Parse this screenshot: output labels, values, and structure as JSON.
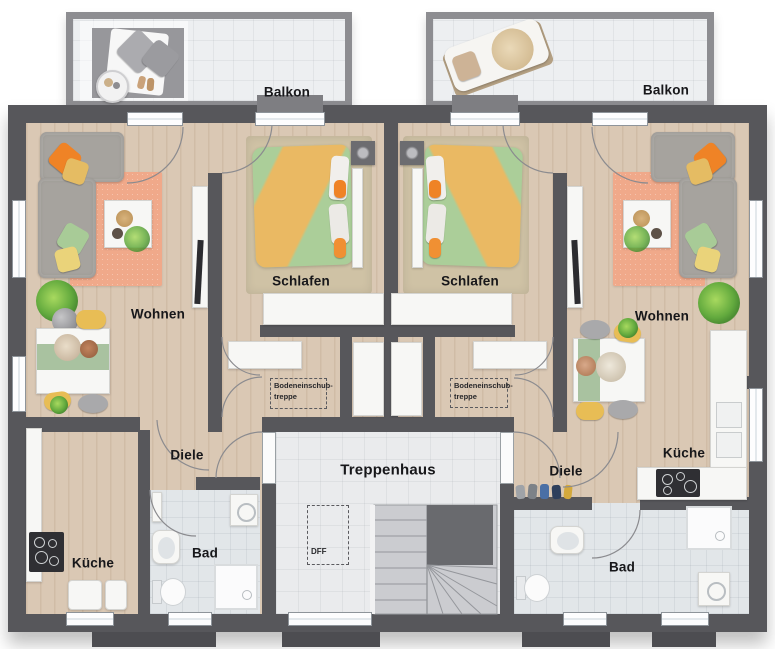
{
  "rooms": [
    {
      "id": "balkon-left",
      "label": "Balkon"
    },
    {
      "id": "balkon-right",
      "label": "Balkon"
    },
    {
      "id": "wohnen-left",
      "label": "Wohnen"
    },
    {
      "id": "schlafen-left",
      "label": "Schlafen"
    },
    {
      "id": "schlafen-right",
      "label": "Schlafen"
    },
    {
      "id": "wohnen-right",
      "label": "Wohnen"
    },
    {
      "id": "diele-left",
      "label": "Diele"
    },
    {
      "id": "treppenhaus",
      "label": "Treppenhaus"
    },
    {
      "id": "diele-right",
      "label": "Diele"
    },
    {
      "id": "kueche-right",
      "label": "Küche"
    },
    {
      "id": "kueche-left",
      "label": "Küche"
    },
    {
      "id": "bad-left",
      "label": "Bad"
    },
    {
      "id": "bad-right",
      "label": "Bad"
    }
  ],
  "annotations": {
    "attic_left": {
      "line1": "Bodeneinschub-",
      "line2": "treppe"
    },
    "attic_right": {
      "line1": "Bodeneinschub-",
      "line2": "treppe"
    },
    "roof_window": {
      "label": "DFF"
    }
  },
  "palette": {
    "wall": "#57575b",
    "wood_floor": "#dac8b4",
    "tile_floor": "#eaebed",
    "bath_tile": "#e2e6e9",
    "rug_salmon": "#f0a98a",
    "bed_green": "#abce99",
    "blanket_orange": "#eab963",
    "accent_orange": "#ef8326",
    "accent_yellow": "#e5bc63",
    "accent_sage": "#a9c2a0",
    "carpet_beige": "#cfc2a5",
    "appliance_black": "#2f2f33"
  }
}
